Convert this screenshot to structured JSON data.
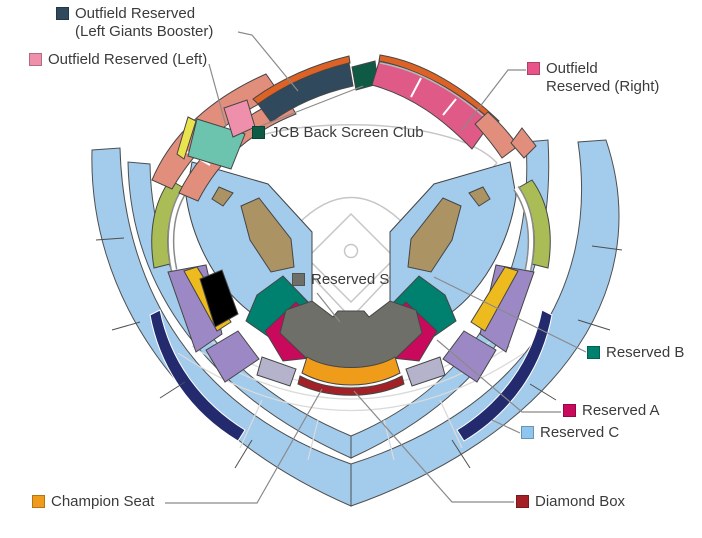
{
  "colors": {
    "light_blue": "#a2cbec",
    "legend_c_blue": "#8fc6ee",
    "navy_stripe": "#232a6d",
    "salmon": "#e28e7d",
    "pink": "#ee8fac",
    "mint": "#6cc3ae",
    "yellow": "#e9e34d",
    "olive": "#a9bc56",
    "booster_navy": "#30495c",
    "stripe_orange": "#dd6226",
    "jcb_green": "#0e5a45",
    "rose": "#df5a87",
    "legend_rose": "#e8548a",
    "tan": "#ab9364",
    "teal": "#00806e",
    "crimson": "#c9095b",
    "purple": "#9c88c4",
    "gold": "#eebb1e",
    "black": "#000000",
    "lavender": "#b5b3cb",
    "gray_s": "#6f6f69",
    "champion_orange": "#f09c1b",
    "diamond_red": "#a32026"
  },
  "legend": {
    "booster": {
      "label_line1": "Outfield Reserved",
      "label_line2": "(Left Giants Booster)"
    },
    "outfield_left": {
      "label": "Outfield Reserved (Left)"
    },
    "jcb": {
      "label": "JCB Back Screen Club"
    },
    "outfield_right": {
      "label_line1": "Outfield",
      "label_line2": "Reserved (Right)"
    },
    "reserved_s": {
      "label": "Reserved S"
    },
    "reserved_b": {
      "label": "Reserved B"
    },
    "reserved_a": {
      "label": "Reserved A"
    },
    "reserved_c": {
      "label": "Reserved C"
    },
    "champion": {
      "label": "Champion Seat"
    },
    "diamond_box": {
      "label": "Diamond Box"
    }
  }
}
